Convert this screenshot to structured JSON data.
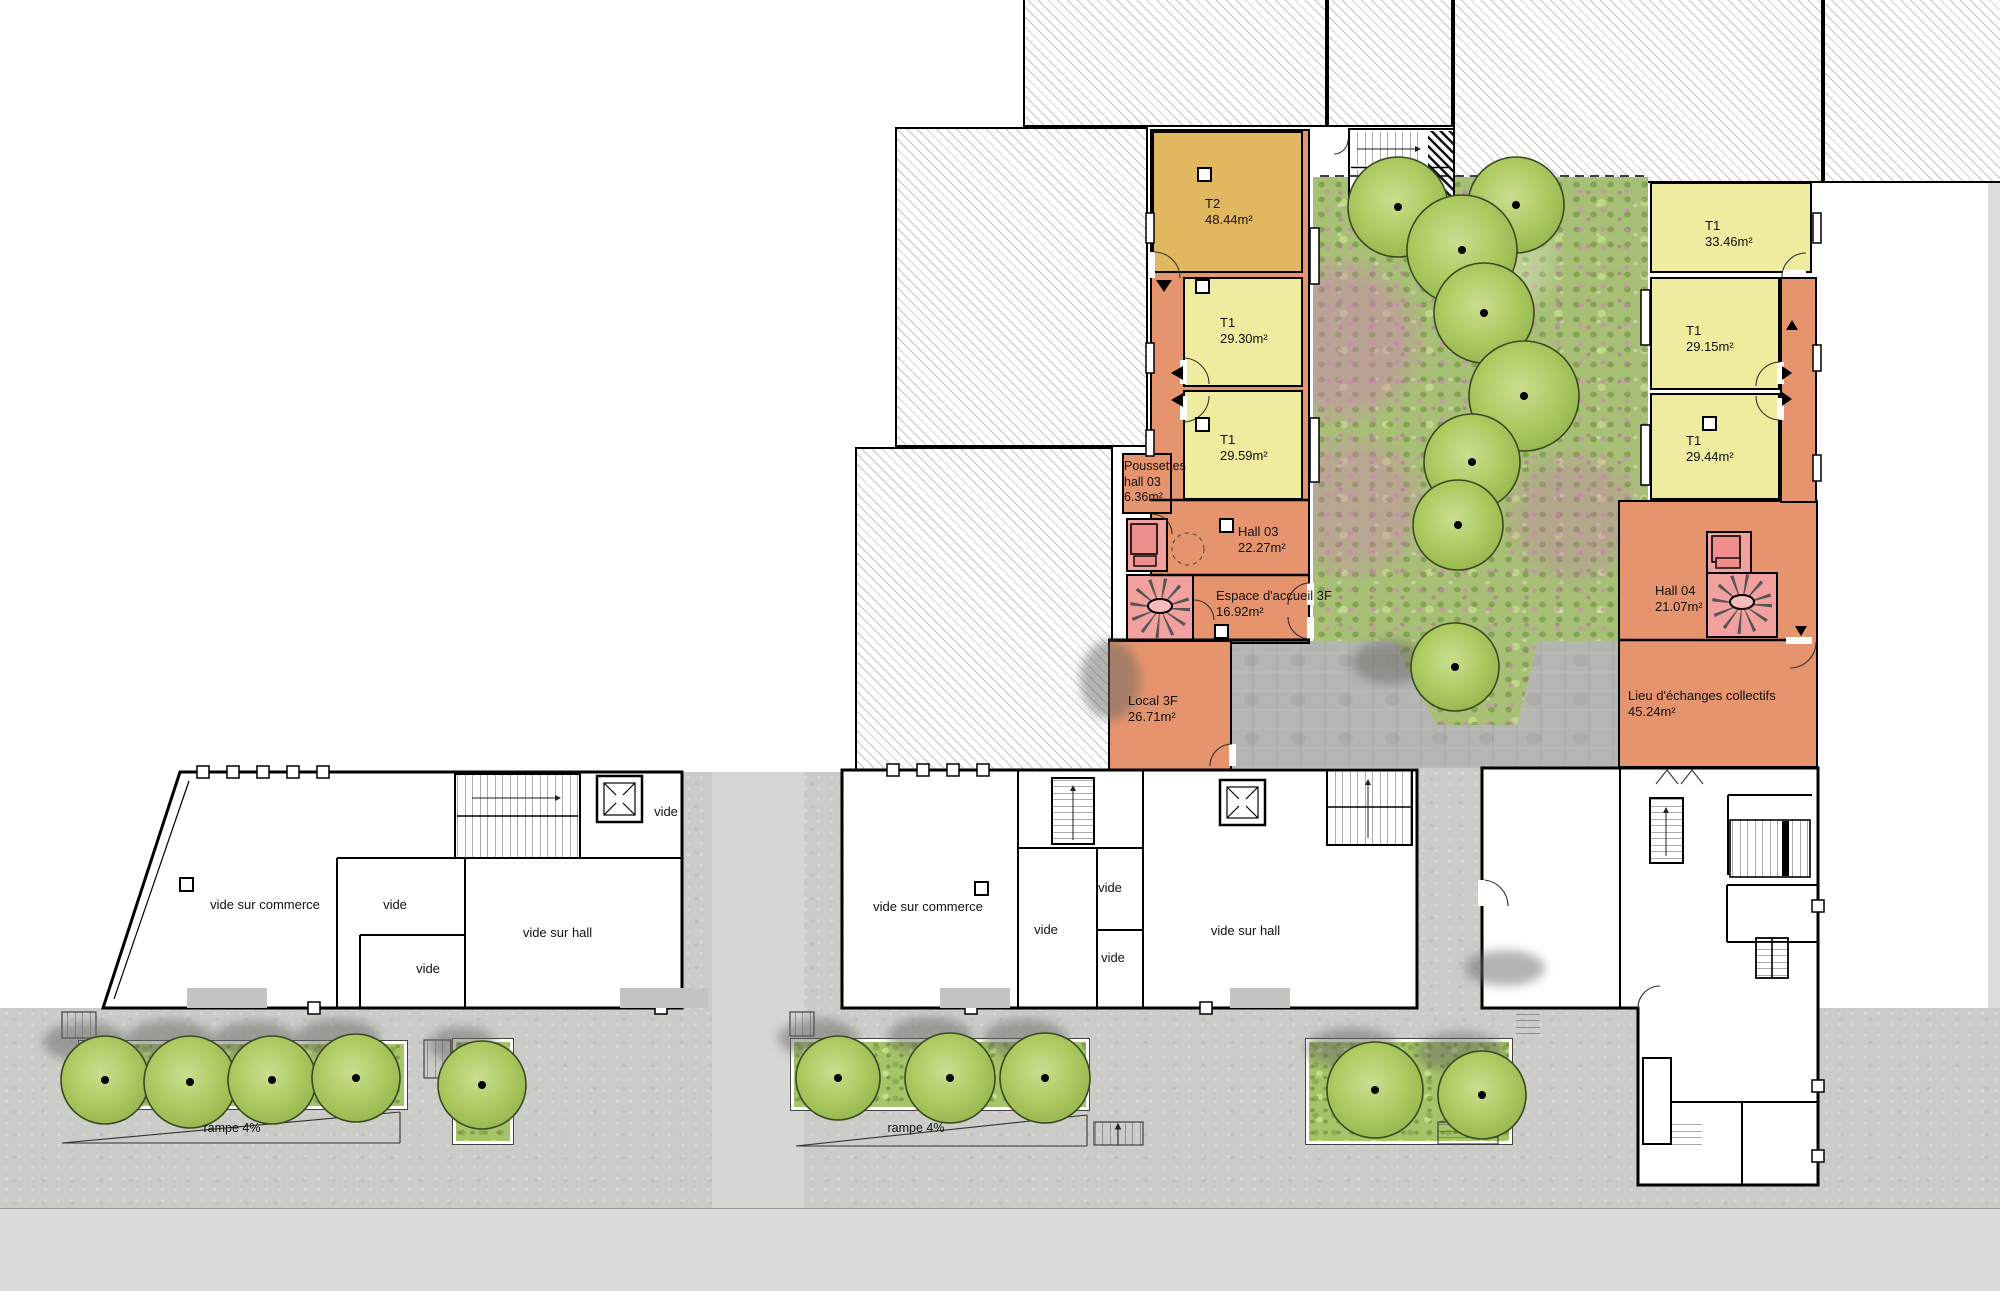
{
  "apartments": [
    {
      "type": "T2",
      "area": "48.44m²"
    },
    {
      "type": "T1",
      "area": "29.30m²"
    },
    {
      "type": "T1",
      "area": "29.59m²"
    },
    {
      "type": "T1",
      "area": "33.46m²"
    },
    {
      "type": "T1",
      "area": "29.15m²"
    },
    {
      "type": "T1",
      "area": "29.44m²"
    }
  ],
  "common_rooms": [
    {
      "line1": "Poussettes",
      "line2": "hall 03",
      "area": "6.36m²"
    },
    {
      "name": "Hall 03",
      "area": "22.27m²"
    },
    {
      "name": "Espace d'accueil 3F",
      "area": "16.92m²"
    },
    {
      "name": "Local 3F",
      "area": "26.71m²"
    },
    {
      "name": "Hall 04",
      "area": "21.07m²"
    },
    {
      "name": "Lieu d'échanges collectifs",
      "area": "45.24m²"
    }
  ],
  "void_labels": {
    "vide_sur_commerce": "vide sur commerce",
    "vide_sur_hall": "vide sur hall",
    "vide": "vide"
  },
  "site_labels": {
    "ramp": "rampe 4%"
  },
  "colors": {
    "apartment_orange": "#e5946e",
    "apartment_yellow": "#efec9f",
    "apartment_tan": "#e1b75f",
    "stair_pink": "#f2a19e",
    "garden_green": "#a8c076",
    "terrace_grey": "#b5b5b2",
    "sidewalk_grey": "#cbcbc8",
    "street_grey": "#d8dbd9"
  }
}
